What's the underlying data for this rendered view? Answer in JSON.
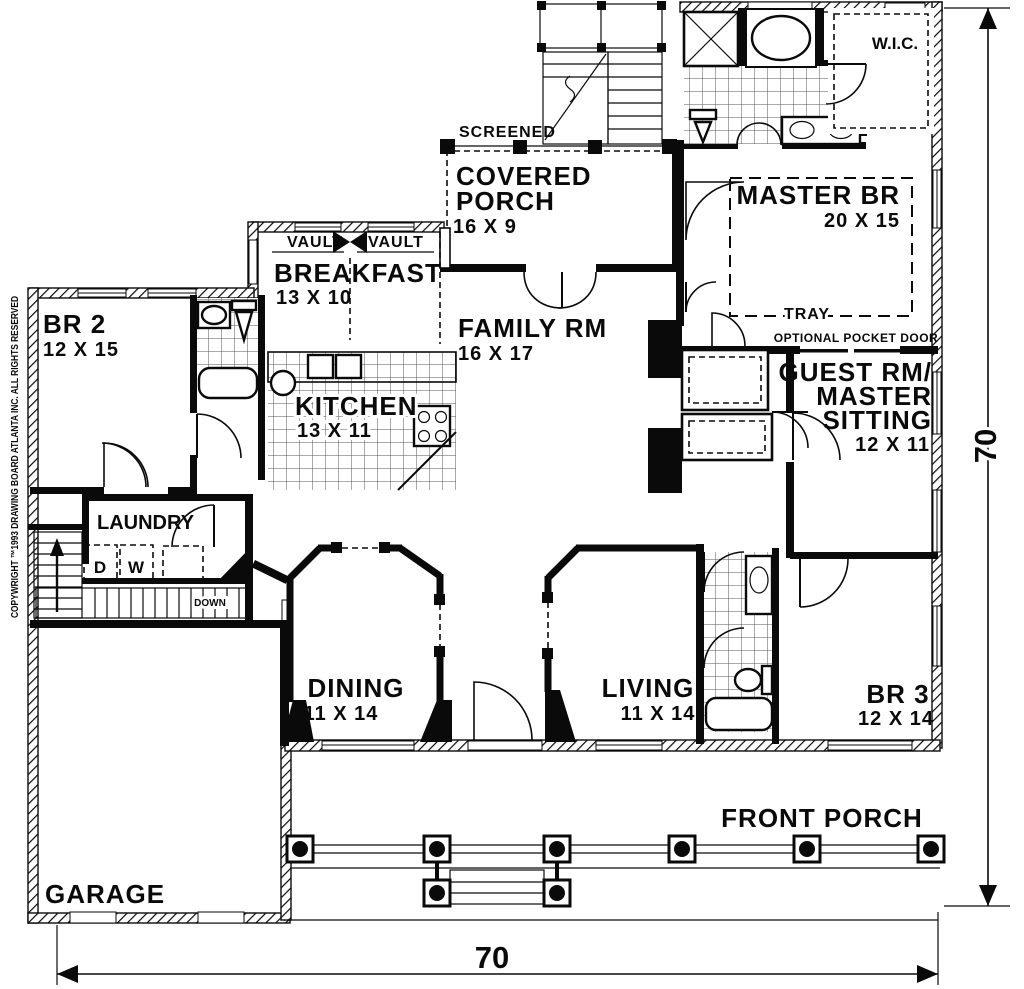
{
  "rooms": {
    "br2": {
      "name": "BR 2",
      "dims": "12 X 15"
    },
    "breakfast": {
      "name": "BREAKFAST",
      "dims": "13 X 10"
    },
    "kitchen": {
      "name": "KITCHEN",
      "dims": "13 X 11"
    },
    "family": {
      "name": "FAMILY RM",
      "dims": "16 X 17"
    },
    "covered_porch": {
      "line1": "COVERED",
      "line2": "PORCH",
      "dims": "16 X 9"
    },
    "master": {
      "name": "MASTER BR",
      "dims": "20 X 15"
    },
    "guest": {
      "line1": "GUEST RM/",
      "line2": "MASTER",
      "line3": "SITTING",
      "dims": "12 X 11"
    },
    "dining": {
      "name": "DINING",
      "dims": "11 X 14"
    },
    "living": {
      "name": "LIVING",
      "dims": "11 X 14"
    },
    "br3": {
      "name": "BR 3",
      "dims": "12 X 14"
    },
    "laundry": {
      "name": "LAUNDRY"
    },
    "garage": {
      "name": "GARAGE"
    },
    "front_porch": {
      "name": "FRONT PORCH"
    },
    "wic": {
      "name": "W.I.C."
    }
  },
  "annotations": {
    "screened": "SCREENED",
    "vault_left": "VAULT",
    "vault_right": "VAULT",
    "tray": "TRAY",
    "optional_pocket_door": "OPTIONAL POCKET DOOR",
    "down": "DOWN",
    "dryer": "D",
    "washer": "W"
  },
  "dimensions": {
    "width": "70",
    "height": "70"
  },
  "copyright": "COPYWRIGHT ™1993 DRAWING BOARD ATLANTA INC. ALL RIGHTS RESERVED",
  "colors": {
    "ink": "#0a0a0a",
    "paper": "#ffffff"
  }
}
